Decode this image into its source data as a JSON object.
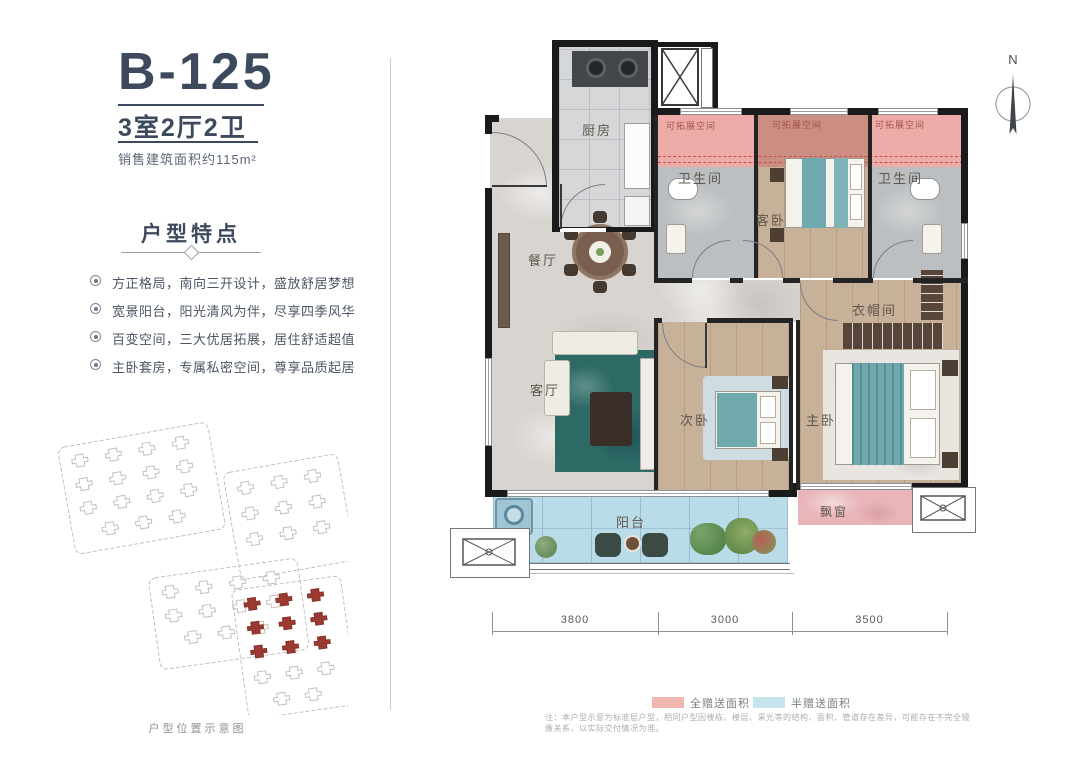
{
  "header": {
    "unit_code": "B-125",
    "layout": "3室2厅2卫",
    "area": "销售建筑面积约115m²"
  },
  "features": {
    "title": "户型特点",
    "items": [
      "方正格局，南向三开设计，盛放舒居梦想",
      "宽景阳台，阳光清风为伴，尽享四季风华",
      "百变空间，三大优居拓展，居住舒适超值",
      "主卧套房，专属私密空间，尊享品质起居"
    ]
  },
  "site_plan": {
    "caption": "户型位置示意图"
  },
  "plan": {
    "north_label": "N",
    "rooms": {
      "kitchen": "厨房",
      "dining": "餐厅",
      "living": "客厅",
      "bath_left": "卫生间",
      "bath_right": "卫生间",
      "guest": "客卧",
      "second": "次卧",
      "master": "主卧",
      "cloak": "衣帽间",
      "balcony": "阳台",
      "bay": "飘窗"
    },
    "expandable": [
      "可拓展空间",
      "可拓展空间",
      "可拓展空间"
    ],
    "dimensions": [
      "3800",
      "3000",
      "3500"
    ]
  },
  "legend": {
    "items": [
      {
        "label": "全赠送面积",
        "color": "#f2b6b1"
      },
      {
        "label": "半赠送面积",
        "color": "#c6e4ee"
      }
    ]
  },
  "colors": {
    "accent": "#3d4a5e",
    "expand_pink": "#edaca7",
    "expand_salmon": "#cc8d82",
    "balcony_blue": "#b9dce8",
    "bay_pink": "#e9b5ba",
    "site_red": "#9c3a31"
  },
  "footnote": "注：本户型示意为标准层户型，相同户型因楼栋、楼层、采光等的结构、面积、管道存在差异，可能存在不完全镜像关系，以实际交付情况为准。"
}
